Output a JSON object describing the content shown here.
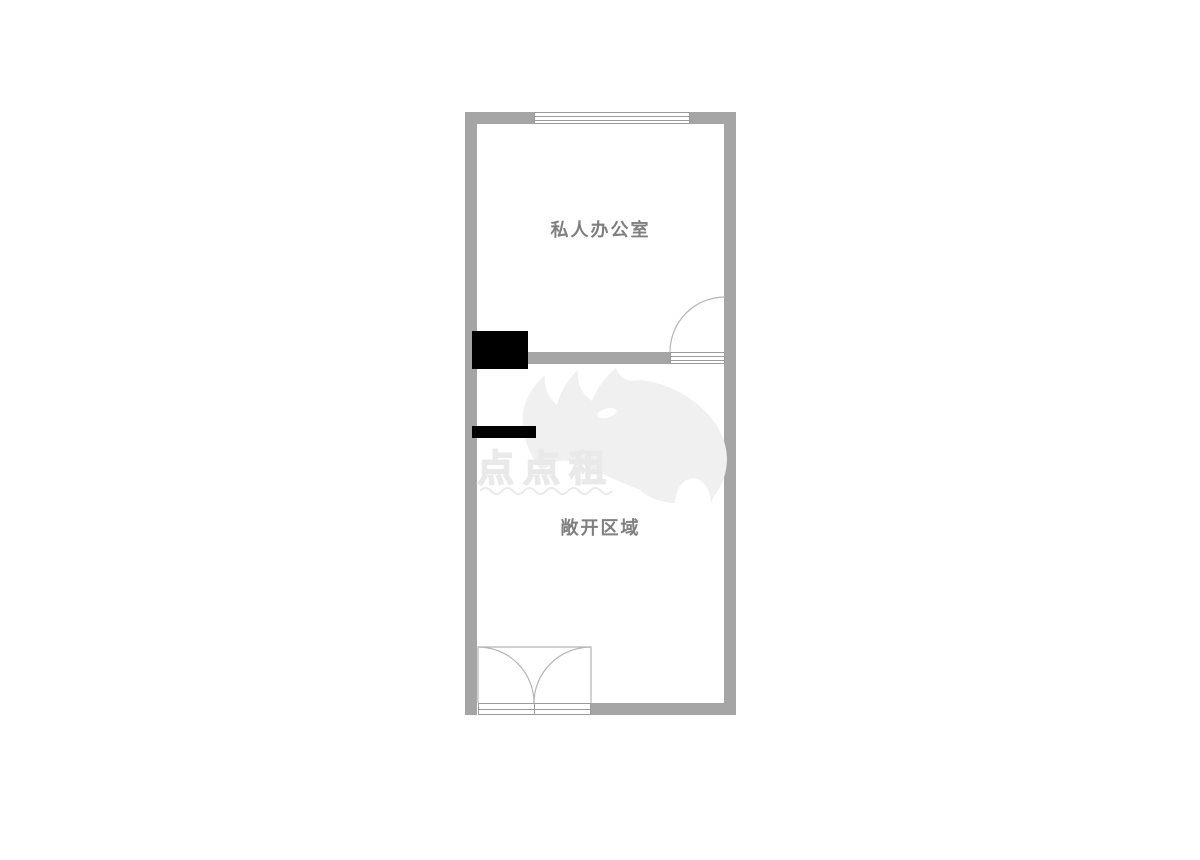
{
  "floorplan": {
    "rooms": [
      {
        "id": "private-office",
        "label": "私人办公室"
      },
      {
        "id": "open-area",
        "label": "敞开区域"
      }
    ],
    "watermark": {
      "brand": "点点租"
    },
    "colors": {
      "wall": "#a5a5a5",
      "room_label": "#7f7f7f",
      "column": "#000000",
      "fixture_border": "#9b9b9b",
      "door_arc": "#b5b5b5",
      "watermark": "#f0f0f0",
      "watermark_stroke": "#e9e9e9",
      "background": "#ffffff"
    }
  }
}
